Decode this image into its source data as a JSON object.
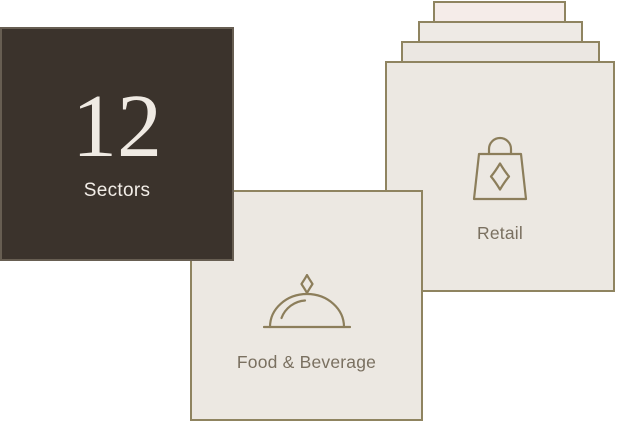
{
  "colors": {
    "background": "#ffffff",
    "card-fill": "#ECE8E2",
    "card-border": "#8F8460",
    "dark-fill": "#3B332C",
    "dark-border": "#675E52",
    "icon-stroke": "#8C7E5B",
    "label-text": "#7A7060",
    "stat-text": "#EFEAE3",
    "stat-label-text": "#F2EDE7",
    "deck1-fill": "#F5ECE9",
    "deck2-fill": "#EEEAE5",
    "deck3-fill": "#EBE7E2"
  },
  "stat_card": {
    "value": "12",
    "label": "Sectors"
  },
  "cards": {
    "retail": {
      "label": "Retail",
      "icon": "shopping-bag-icon"
    },
    "food_beverage": {
      "label": "Food & Beverage",
      "icon": "cloche-icon"
    }
  }
}
